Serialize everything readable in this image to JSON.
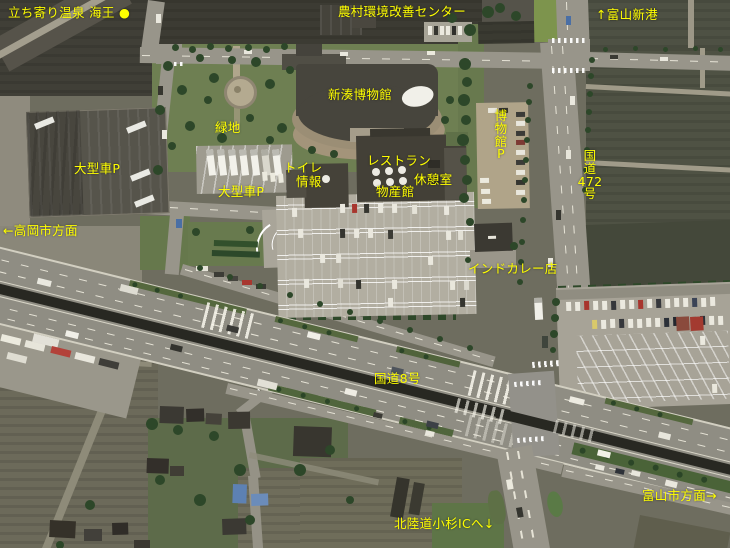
{
  "map": {
    "type": "satellite-photo-guide-map",
    "label_color": "#ffff00",
    "labels": [
      {
        "name": "spa-kaio",
        "text": "立ち寄り温泉 海王 ●"
      },
      {
        "name": "rural-environment-center",
        "text": "農村環境改善センター"
      },
      {
        "name": "toyama-shinko-port",
        "text": "↑富山新港"
      },
      {
        "name": "shinminato-museum",
        "text": "新湊博物館"
      },
      {
        "name": "green-space",
        "text": "緑地"
      },
      {
        "name": "large-vehicle-parking-west",
        "text": "大型車P"
      },
      {
        "name": "toilet",
        "text": "トイレ"
      },
      {
        "name": "information",
        "text": "情報"
      },
      {
        "name": "restaurant",
        "text": "レストラン"
      },
      {
        "name": "rest-room",
        "text": "休憩室"
      },
      {
        "name": "products-hall",
        "text": "物産館"
      },
      {
        "name": "large-vehicle-parking-center",
        "text": "大型車P"
      },
      {
        "name": "museum-parking",
        "text": "博\n物\n館\nP"
      },
      {
        "name": "route-472",
        "text": "国\n道\n472\n号"
      },
      {
        "name": "to-takaoka-city",
        "text": "←高岡市方面"
      },
      {
        "name": "indian-curry-shop",
        "text": "インドカレー店"
      },
      {
        "name": "route-8",
        "text": "国道8号"
      },
      {
        "name": "to-toyama-city",
        "text": "富山市方面→"
      },
      {
        "name": "to-hokuriku-kosugi-ic",
        "text": "北陸道小杉ICへ↓"
      }
    ]
  }
}
